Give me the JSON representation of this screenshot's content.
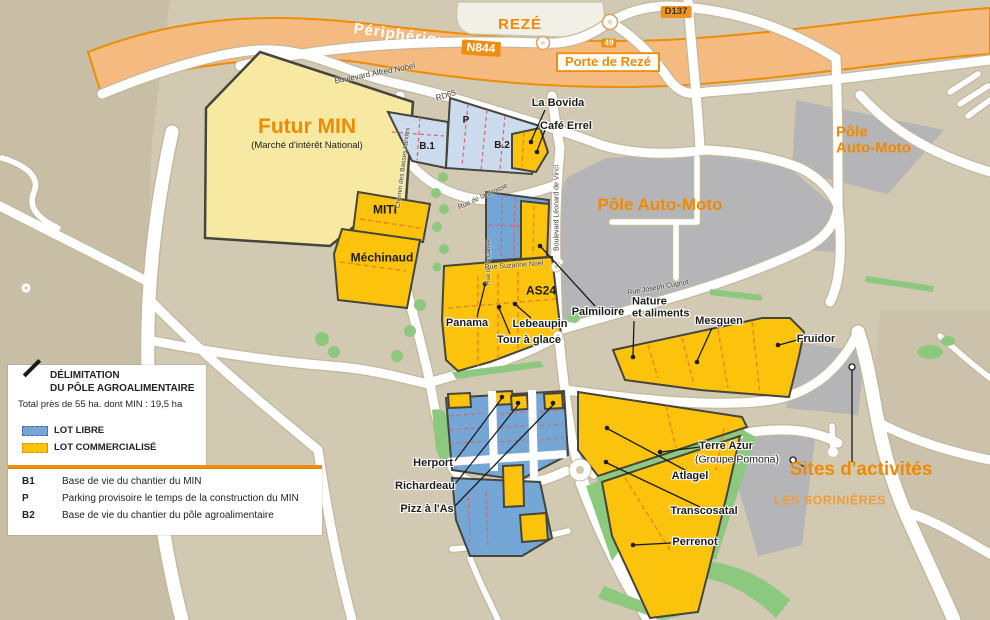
{
  "colors": {
    "accent_orange": "#f18a00",
    "badge_orange": "#ee8d0e",
    "highway_fill": "#f5ba80",
    "highway_edge": "#ed8c05",
    "background": "#d2c9b3",
    "background_dark": "#c8bea6",
    "lot_commercial": "#fcc30c",
    "lot_free": "#74a7d6",
    "lot_free_light": "#ccdcee",
    "futur_min_fill": "#f8e9a2",
    "gray_zone": "#b5b4b6",
    "green": "#8cc87e",
    "lot_border": "#45453e"
  },
  "badges": {
    "reze": "REZÉ",
    "peripherique": "Périphérique",
    "n844": "N844",
    "exit_49": "49",
    "porte_de_reze": "Porte de Rezé",
    "d137": "D137"
  },
  "streets": {
    "bd_alfred_nobel": "Boulevard Alfred Nobel",
    "rd65": "RD65",
    "rue_de_la_brosse": "Rue de la Brosse",
    "bd_leonard_de_vinci": "Boulevard Léonard de Vinci",
    "chemin_des_basses_landes": "Chemin des Basses Landes",
    "rue_de_la_carree": "Rue de la Carrée",
    "rue_suzanne_noel": "Rue Suzanne Noël",
    "rue_joseph_cugnot": "Rue Joseph Cugnot"
  },
  "areas": {
    "futur_min": "Futur MIN",
    "futur_min_sub": "(Marché d'intérêt National)",
    "pole_auto_moto": "Pôle Auto-Moto",
    "pole_auto_moto_l1": "Pôle",
    "pole_auto_moto_l2": "Auto-Moto",
    "sites_activites": "Sites d'activités",
    "les_sorinieres": "LES SORINIÈRES"
  },
  "lots": {
    "b1": "B.1",
    "p": "P",
    "b2": "B.2",
    "miti": "MITI",
    "mechinaud": "Méchinaud",
    "as24": "AS24",
    "la_bovida": "La Bovida",
    "cafe_errel": "Café Errel",
    "panama": "Panama",
    "lebeaupin": "Lebeaupin",
    "tour_a_glace": "Tour à glace",
    "palmiloire": "Palmiloire",
    "nature_l1": "Nature",
    "nature_l2": "et aliments",
    "mesguen": "Mesguen",
    "fruidor": "Fruidor",
    "terre_azur": "Terre Azur",
    "groupe_pomona": "(Groupe Pomona)",
    "atlagel": "Atlagel",
    "transcosatal": "Transcosatal",
    "perrenot": "Perrenot",
    "herport": "Herport",
    "richardeau": "Richardeau",
    "pizz_a_las": "Pizz à l'As"
  },
  "legend": {
    "title_l1": "DÉLIMITATION",
    "title_l2": "DU PÔLE AGROALIMENTAIRE",
    "total": "Total près de 55 ha. dont MIN : 19,5 ha",
    "lot_libre": "LOT LIBRE",
    "lot_commercialise": "LOT COMMERCIALISÉ",
    "b1_key": "B1",
    "b1_desc": "Base de vie du chantier du MIN",
    "p_key": "P",
    "p_desc": "Parking provisoire le temps de la construction du MIN",
    "b2_key": "B2",
    "b2_desc": "Base de vie du chantier du pôle agroalimentaire"
  }
}
